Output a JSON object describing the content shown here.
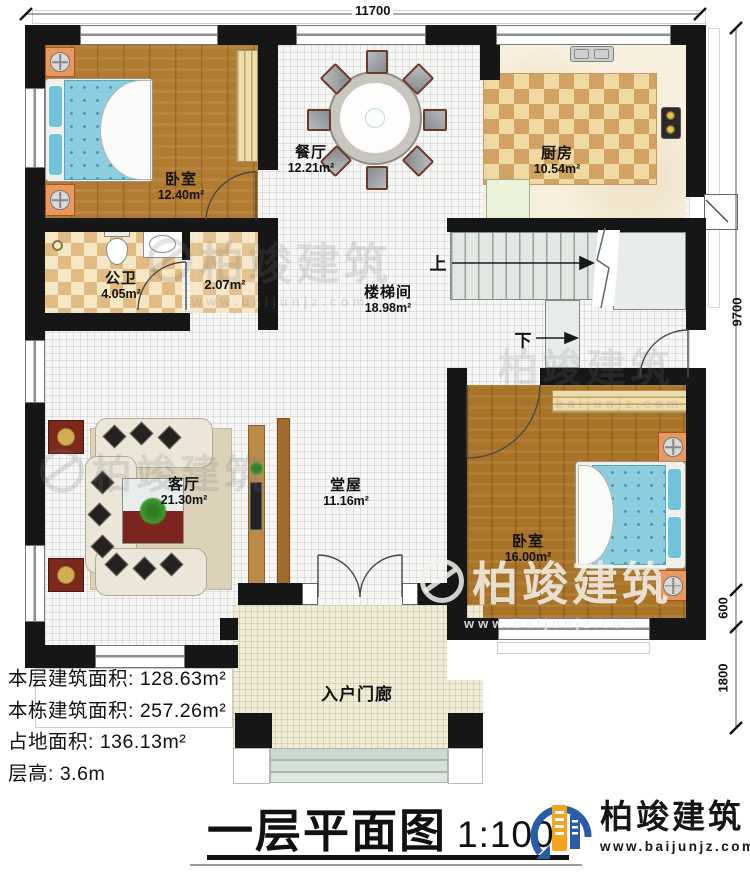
{
  "title": {
    "main": "一层平面图",
    "scale": "1:100"
  },
  "brand": {
    "name": "柏竣建筑",
    "site": "www.baijunjz.com"
  },
  "watermark": {
    "name": "柏竣建筑",
    "site": "www.baijunjz.com"
  },
  "dims": {
    "top": "11700",
    "right_main": "9700",
    "right_600": "600",
    "right_1800": "1800"
  },
  "stairs": {
    "up": "上",
    "down": "下"
  },
  "rooms": {
    "bedroom1": {
      "name": "卧室",
      "area": "12.40m²"
    },
    "dining": {
      "name": "餐厅",
      "area": "12.21m²"
    },
    "kitchen": {
      "name": "厨房",
      "area": "10.54m²"
    },
    "bath": {
      "name": "公卫",
      "area": "4.05m²"
    },
    "vestibule": {
      "area": "2.07m²"
    },
    "stairwell": {
      "name": "楼梯间",
      "area": "18.98m²"
    },
    "living": {
      "name": "客厅",
      "area": "21.30m²"
    },
    "hall": {
      "name": "堂屋",
      "area": "11.16m²"
    },
    "bedroom2": {
      "name": "卧室",
      "area": "16.00m²"
    },
    "porch": {
      "name": "入户门廊"
    }
  },
  "info": [
    "本层建筑面积: 128.63m²",
    "本栋建筑面积: 257.26m²",
    "占地面积: 136.13m²",
    "层高: 3.6m"
  ],
  "colors": {
    "wall": "#161616",
    "logo_blue": "#2b5ca8",
    "logo_orange": "#f5a21d",
    "bed_blue": "#8ccddf",
    "wood": "#b17c31"
  }
}
